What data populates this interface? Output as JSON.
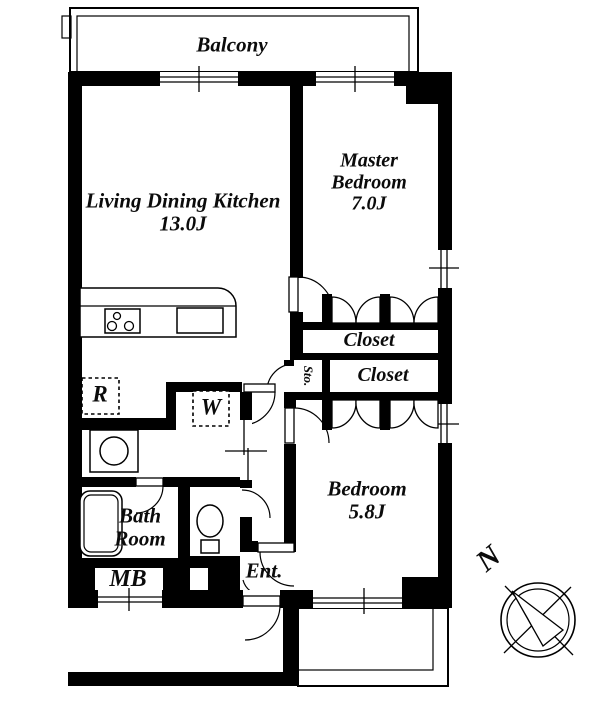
{
  "plan": {
    "balcony_label": "Balcony",
    "compass_north_label": "N",
    "rooms": {
      "ldk": {
        "name": "Living Dining Kitchen",
        "size": "13.0J"
      },
      "master_bedroom": {
        "name_line1": "Master",
        "name_line2": "Bedroom",
        "size": "7.0J"
      },
      "bedroom": {
        "name": "Bedroom",
        "size": "5.8J"
      },
      "bathroom": {
        "name_line1": "Bath",
        "name_line2": "Room"
      },
      "entrance": {
        "abbr": "Ent."
      },
      "closet_upper": {
        "name": "Closet"
      },
      "closet_lower": {
        "name": "Closet"
      },
      "storage": {
        "abbr": "Sto."
      }
    },
    "fixtures": {
      "refrigerator_abbr": "R",
      "washer_abbr": "W",
      "meter_box_abbr": "MB"
    },
    "colors": {
      "wall": "#000000",
      "background": "#ffffff",
      "line": "#000000"
    }
  }
}
